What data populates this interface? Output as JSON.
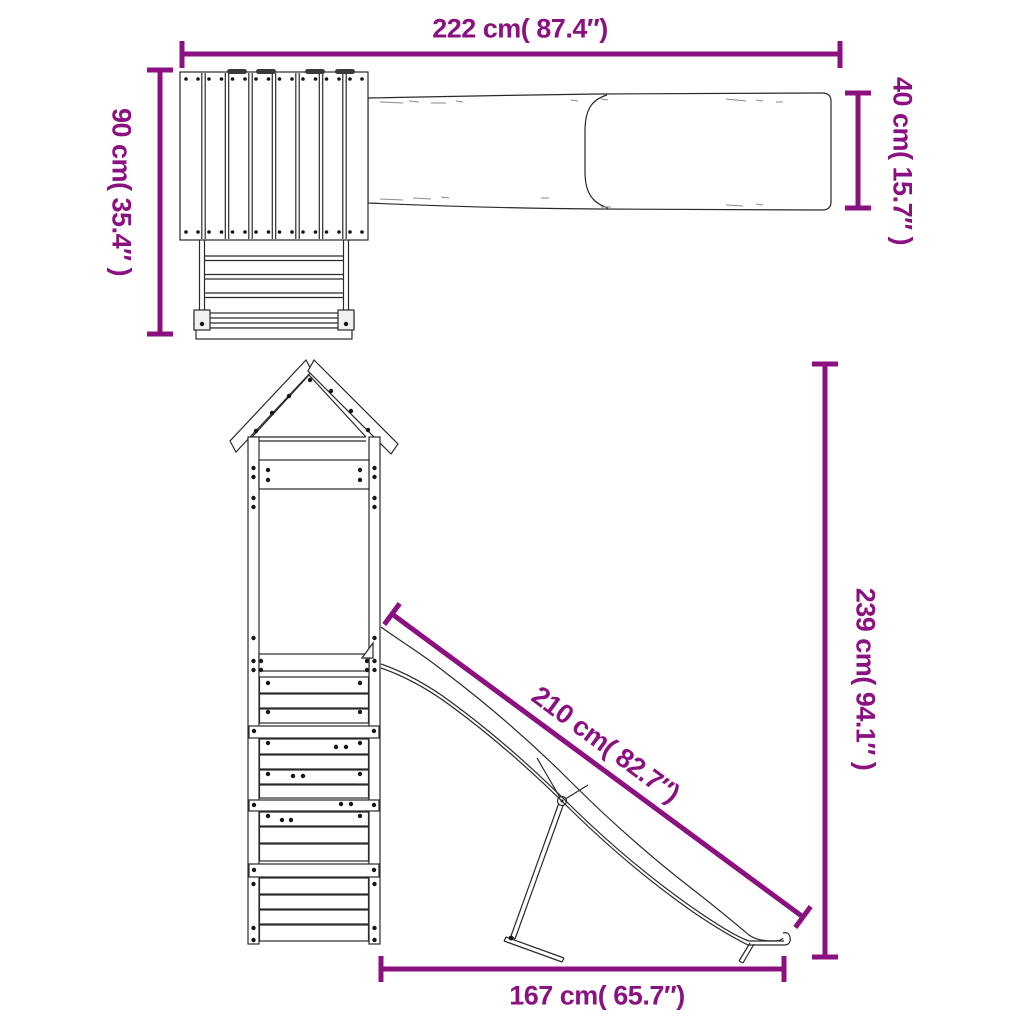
{
  "title": "Playhouse with slide dimension diagram",
  "colors": {
    "dimension_accent": "#8B1180",
    "drawing_line": "#2a2a2a",
    "background": "#ffffff"
  },
  "dimensions": {
    "overall_width": "222 cm( 87.4″)",
    "overall_depth": "90 cm( 35.4″ )",
    "slide_width": "40 cm( 15.7″ )",
    "slide_length": "210 cm( 82.7″)",
    "overall_height": "239 cm( 94.1″ )",
    "base_length": "167 cm( 65.7″)"
  }
}
